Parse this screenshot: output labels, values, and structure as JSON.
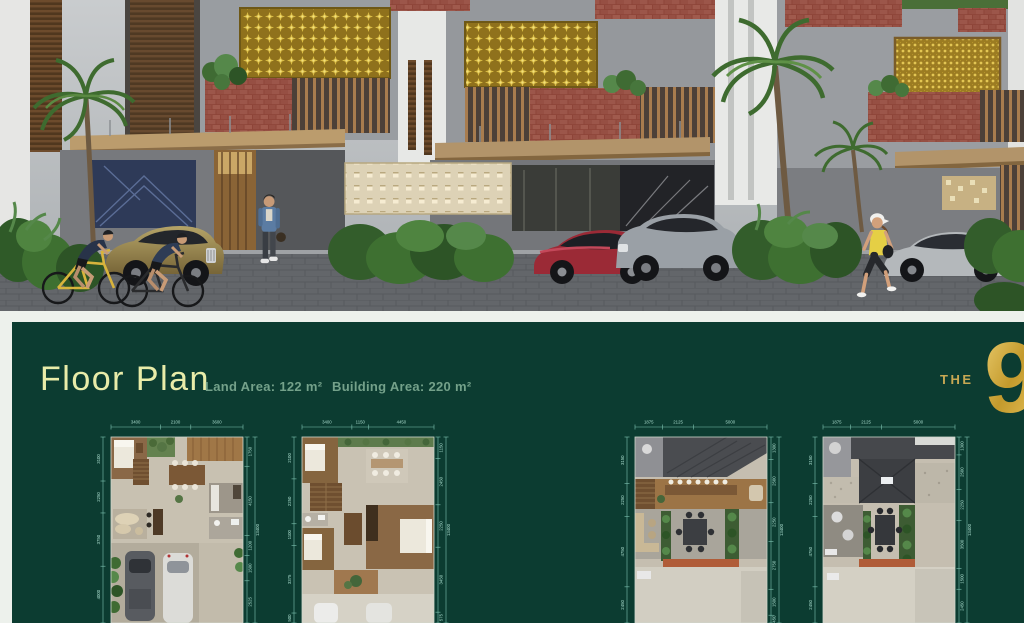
{
  "floor_plan_section": {
    "title": "Floor Plan",
    "land_area": "Land Area: 122 m²",
    "building_area": "Building Area: 220 m²",
    "logo_the": "THE",
    "logo_numeral": "9",
    "colors": {
      "panel_bg": "#0c3c31",
      "gap_bg": "#edf1ec",
      "title": "#e9eca9",
      "subtitle": "#74a18a",
      "dimension_line": "#7fc4b2",
      "dimension_text": "#a9dccd",
      "logo_gold": "#c9a23a"
    },
    "plans": [
      {
        "dims_top": [
          "3400",
          "2100",
          "3600"
        ],
        "dims_left": [
          "3100",
          "2250",
          "3750",
          "4000"
        ],
        "dims_right": [
          "1750",
          "4150",
          "1200",
          "1500",
          "2525"
        ],
        "dim_total": "13400"
      },
      {
        "dims_top": [
          "3400",
          "1150",
          "4450"
        ],
        "dims_left": [
          "2100",
          "2250",
          "1100",
          "3375",
          "500"
        ],
        "dims_right": [
          "1150",
          "2450",
          "2250",
          "3450",
          "575"
        ],
        "dim_total": "13400"
      },
      {
        "dims_top": [
          "1875",
          "2125",
          "5000"
        ],
        "dims_left": [
          "3150",
          "2250",
          "4750",
          "2450"
        ],
        "dims_right": [
          "1300",
          "2500",
          "2250",
          "2750",
          "1500",
          "450"
        ],
        "dim_total": "13400"
      },
      {
        "dims_top": [
          "1875",
          "2125",
          "5000"
        ],
        "dims_left": [
          "3150",
          "2250",
          "4750",
          "2450"
        ],
        "dims_right": [
          "1300",
          "2500",
          "2250",
          "3500",
          "1500",
          "2450"
        ],
        "dim_total": "13400"
      }
    ]
  }
}
